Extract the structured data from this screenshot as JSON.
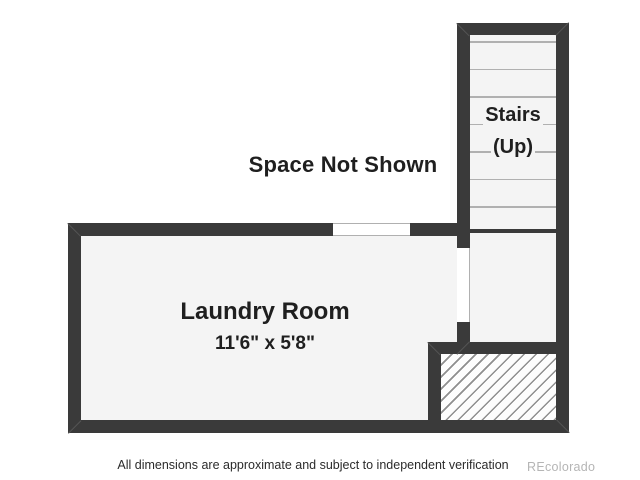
{
  "floorplan": {
    "space_not_shown_label": "Space Not Shown",
    "stairs": {
      "label_line1": "Stairs",
      "label_line2": "(Up)",
      "step_count": 7
    },
    "laundry": {
      "name": "Laundry Room",
      "dimensions": "11'6\" x 5'8\""
    },
    "footer": {
      "disclaimer": "All dimensions are approximate and subject to independent verification",
      "watermark": "REcolorado"
    },
    "colors": {
      "wall": "#3a3a3a",
      "room_fill": "#f4f4f4",
      "step_line": "#b0b0b0",
      "hatch_line": "#8f8f8f",
      "label_text": "#1f1f1f",
      "watermark": "#b5b5b5"
    }
  }
}
